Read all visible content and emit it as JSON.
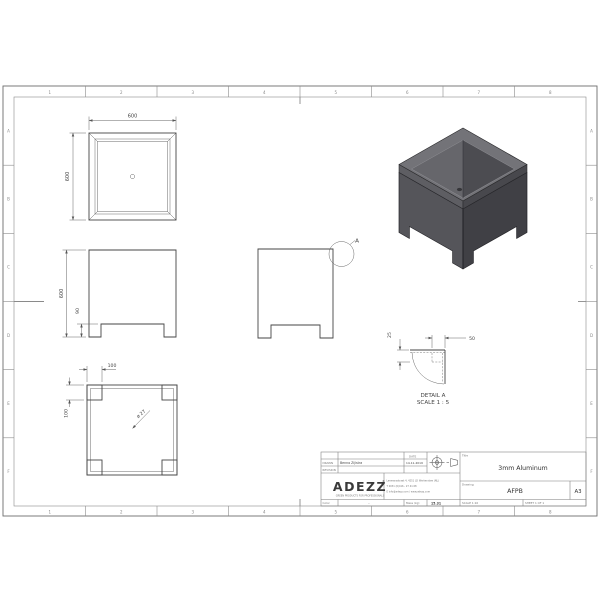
{
  "sheet": {
    "cols": [
      "1",
      "2",
      "3",
      "4",
      "5",
      "6",
      "7",
      "8"
    ],
    "rows": [
      "A",
      "B",
      "C",
      "D",
      "E",
      "F"
    ]
  },
  "views": {
    "top_view": {
      "width": "600",
      "height": "600"
    },
    "front_view": {
      "height": "600",
      "foot_height": "90"
    },
    "bottom_view": {
      "foot_width": "100",
      "foot_depth": "100",
      "hole": "ø 27"
    },
    "side_view": {
      "detail_marker": "A"
    },
    "detail_view": {
      "name": "DETAIL A",
      "scale": "SCALE 1 : 5",
      "top_width": "50",
      "fold_depth": "25"
    }
  },
  "title_block": {
    "drawn_label": "DRAWN",
    "drawn_value": "Benno Zijlstra",
    "revision_label": "REVISION",
    "date_label": "DATE",
    "date_value": "14-11-2019",
    "logo": "ADEZZ",
    "logo_mark": "®",
    "logo_tagline": "GREEN PRODUCTS FOR PROFESSIONALS",
    "address_line1": "Leemansstraat 4, 4251 LD Werkendam (NL)",
    "address_line2": "T 0031 (0)416 - 27 41 68",
    "address_line3": "E info@adezz.com / www.adezz.com",
    "color_label": "Color",
    "color_value": "-",
    "mass_label": "Mass (kg)",
    "mass_value": "15.31",
    "title_label": "Title",
    "title_value": "3mm Aluminum",
    "drawing_label": "Drawing",
    "drawing_value": "AFPB",
    "paper_size": "A3",
    "scale_label": "SCALE 1:10",
    "sheet_label": "SHEET 1 OF 1"
  },
  "colors": {
    "iso_left": "#55555a",
    "iso_right": "#404045",
    "iso_top": "#737378",
    "line": "#454545"
  }
}
